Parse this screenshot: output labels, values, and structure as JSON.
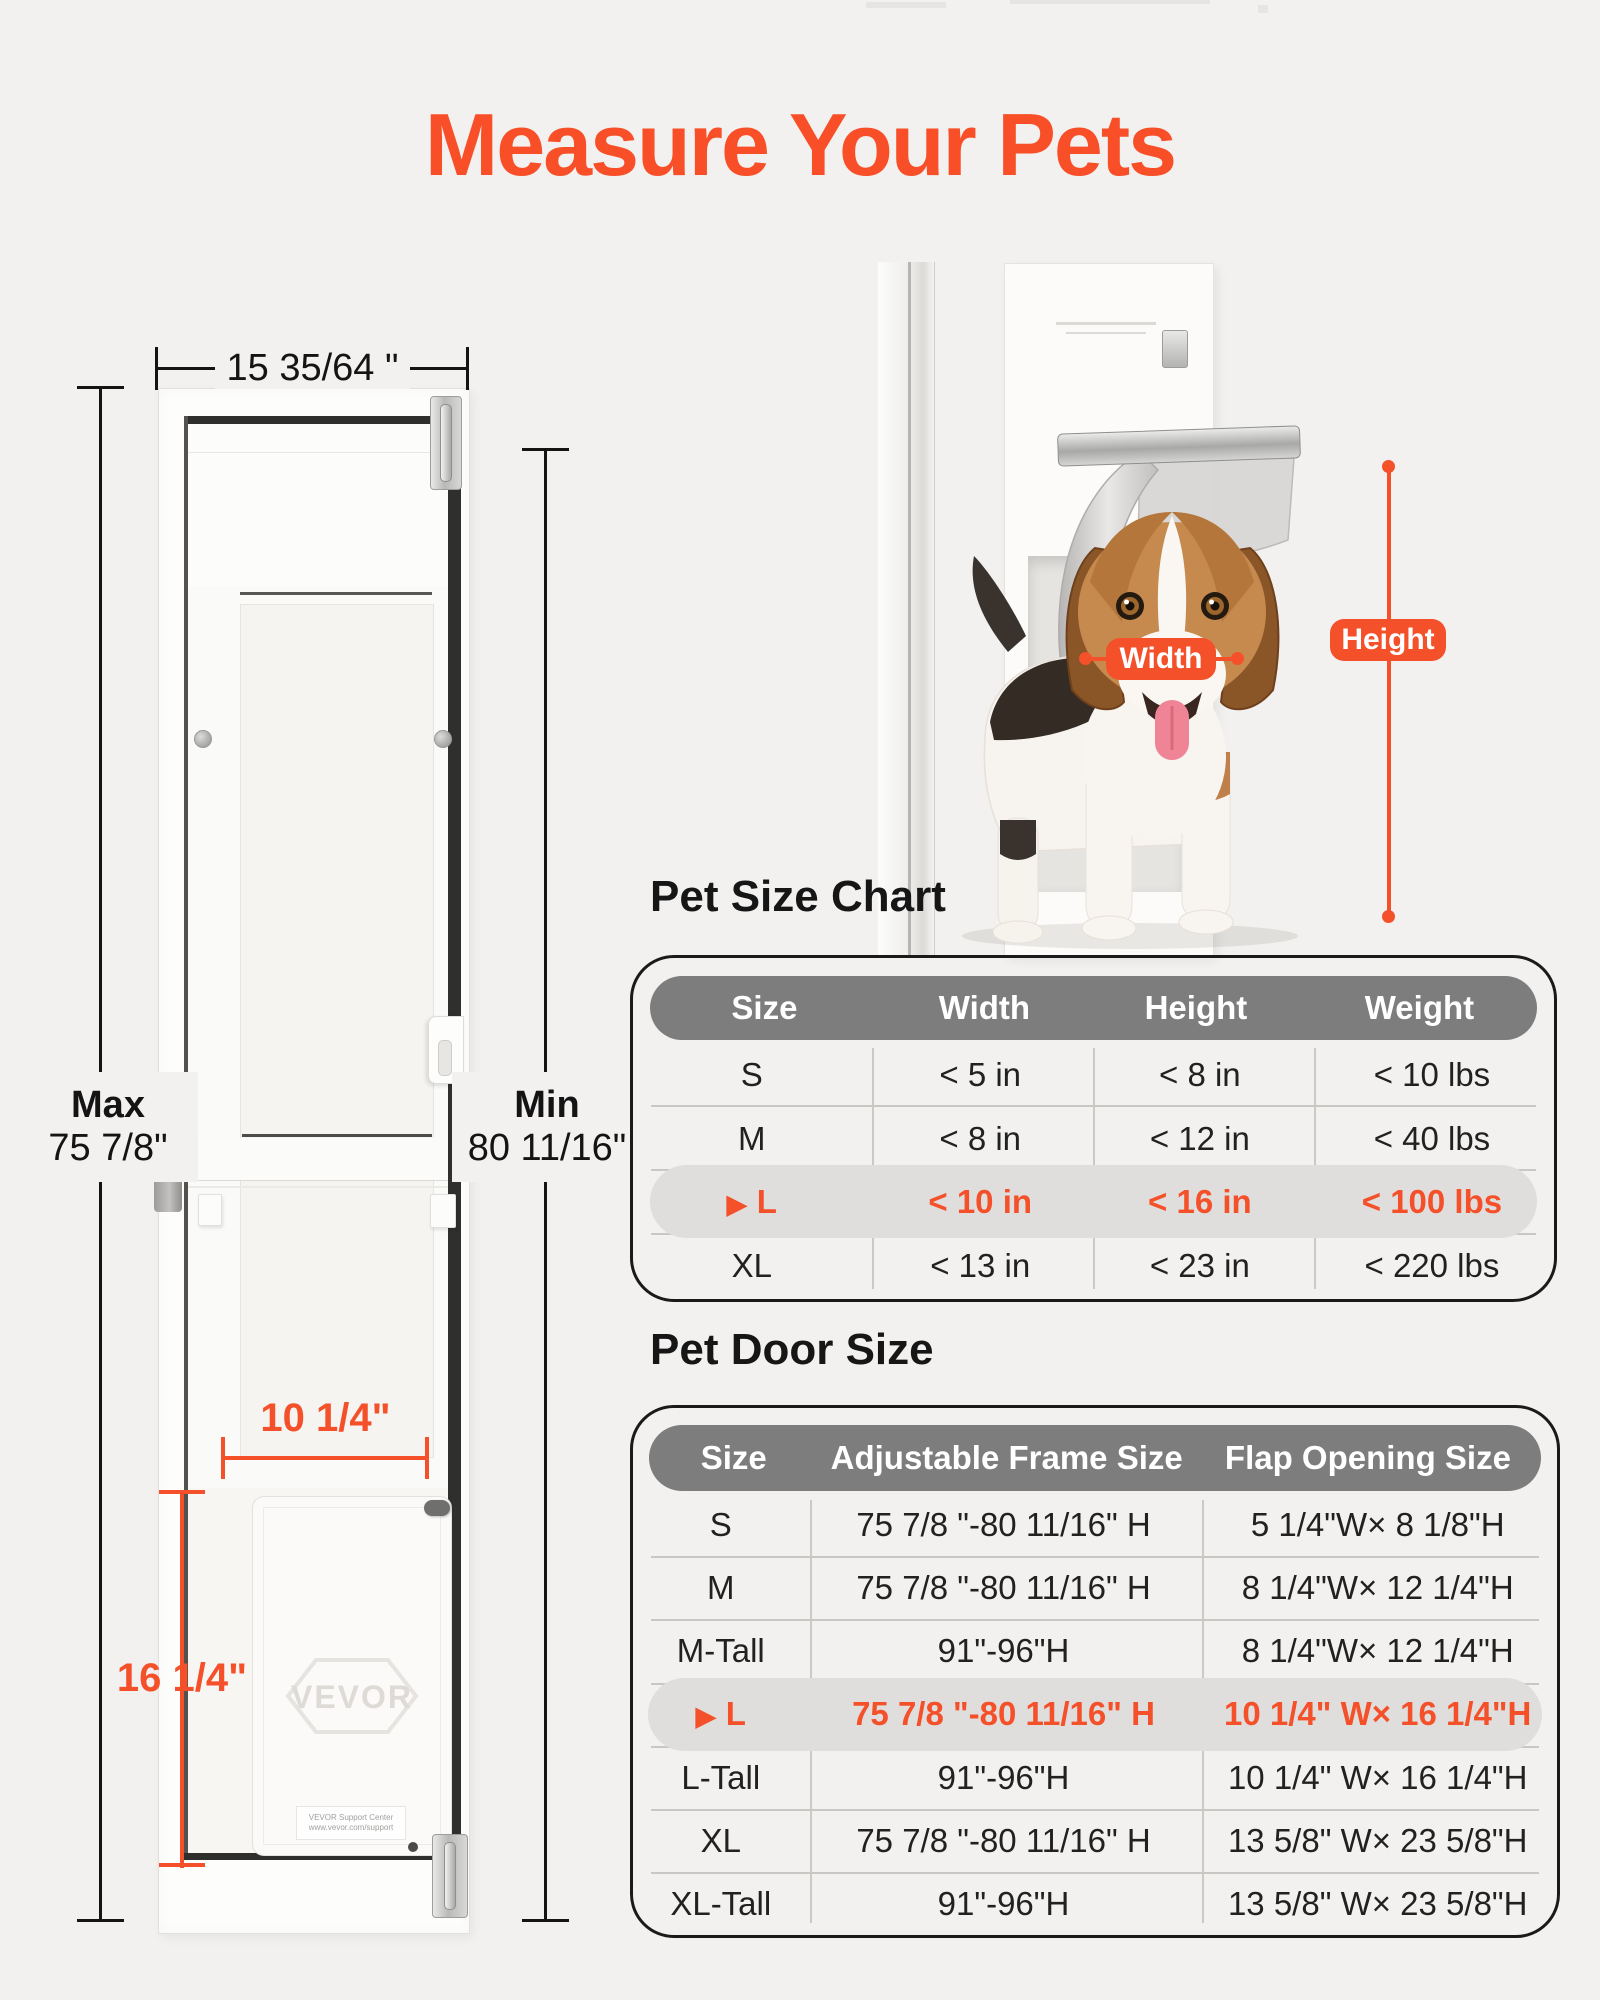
{
  "page": {
    "title": "Measure Your Pets",
    "background": "#f2f1ef",
    "accent_color": "#f4502a",
    "header_gray": "#7d7d7d",
    "highlight_gray": "#e0dedc"
  },
  "door_diagram": {
    "brand_logo": "VEVOR",
    "support_label_line1": "VEVOR Support Center",
    "support_label_line2": "www.vevor.com/support",
    "dimensions": {
      "top_width": "15 35/64 \"",
      "left_label": "Max",
      "left_value": "75 7/8\"",
      "right_label": "Min",
      "right_value": "80 11/16\"",
      "flap_width": "10 1/4\"",
      "flap_height": "16 1/4\""
    }
  },
  "measure_photo": {
    "width_tag": "Width",
    "height_tag": "Height"
  },
  "pet_size_chart": {
    "heading": "Pet Size Chart",
    "marker": "▶",
    "columns": [
      "Size",
      "Width",
      "Height",
      "Weight"
    ],
    "rows": [
      {
        "size": "S",
        "width": "< 5 in",
        "height": "< 8 in",
        "weight": "< 10 lbs"
      },
      {
        "size": "M",
        "width": "< 8 in",
        "height": "< 12 in",
        "weight": "< 40 lbs"
      },
      {
        "size": "L",
        "width": "< 10 in",
        "height": "< 16 in",
        "weight": "< 100 lbs",
        "highlighted": true
      },
      {
        "size": "XL",
        "width": "< 13 in",
        "height": "< 23 in",
        "weight": "< 220 lbs"
      }
    ]
  },
  "pet_door_size": {
    "heading": "Pet Door Size",
    "marker": "▶",
    "columns": [
      "Size",
      "Adjustable Frame Size",
      "Flap Opening Size"
    ],
    "rows": [
      {
        "size": "S",
        "frame": "75 7/8 \"-80 11/16\" H",
        "flap": "5 1/4\"W× 8 1/8\"H"
      },
      {
        "size": "M",
        "frame": "75 7/8 \"-80 11/16\" H",
        "flap": "8 1/4\"W× 12 1/4\"H"
      },
      {
        "size": "M-Tall",
        "frame": "91\"-96\"H",
        "flap": "8 1/4\"W× 12 1/4\"H"
      },
      {
        "size": "L",
        "frame": "75 7/8 \"-80 11/16\" H",
        "flap": "10 1/4\" W× 16 1/4\"H",
        "highlighted": true
      },
      {
        "size": "L-Tall",
        "frame": "91\"-96\"H",
        "flap": "10 1/4\" W× 16 1/4\"H"
      },
      {
        "size": "XL",
        "frame": "75 7/8 \"-80 11/16\" H",
        "flap": "13 5/8\" W× 23 5/8\"H"
      },
      {
        "size": "XL-Tall",
        "frame": "91\"-96\"H",
        "flap": "13 5/8\" W× 23 5/8\"H"
      }
    ]
  }
}
